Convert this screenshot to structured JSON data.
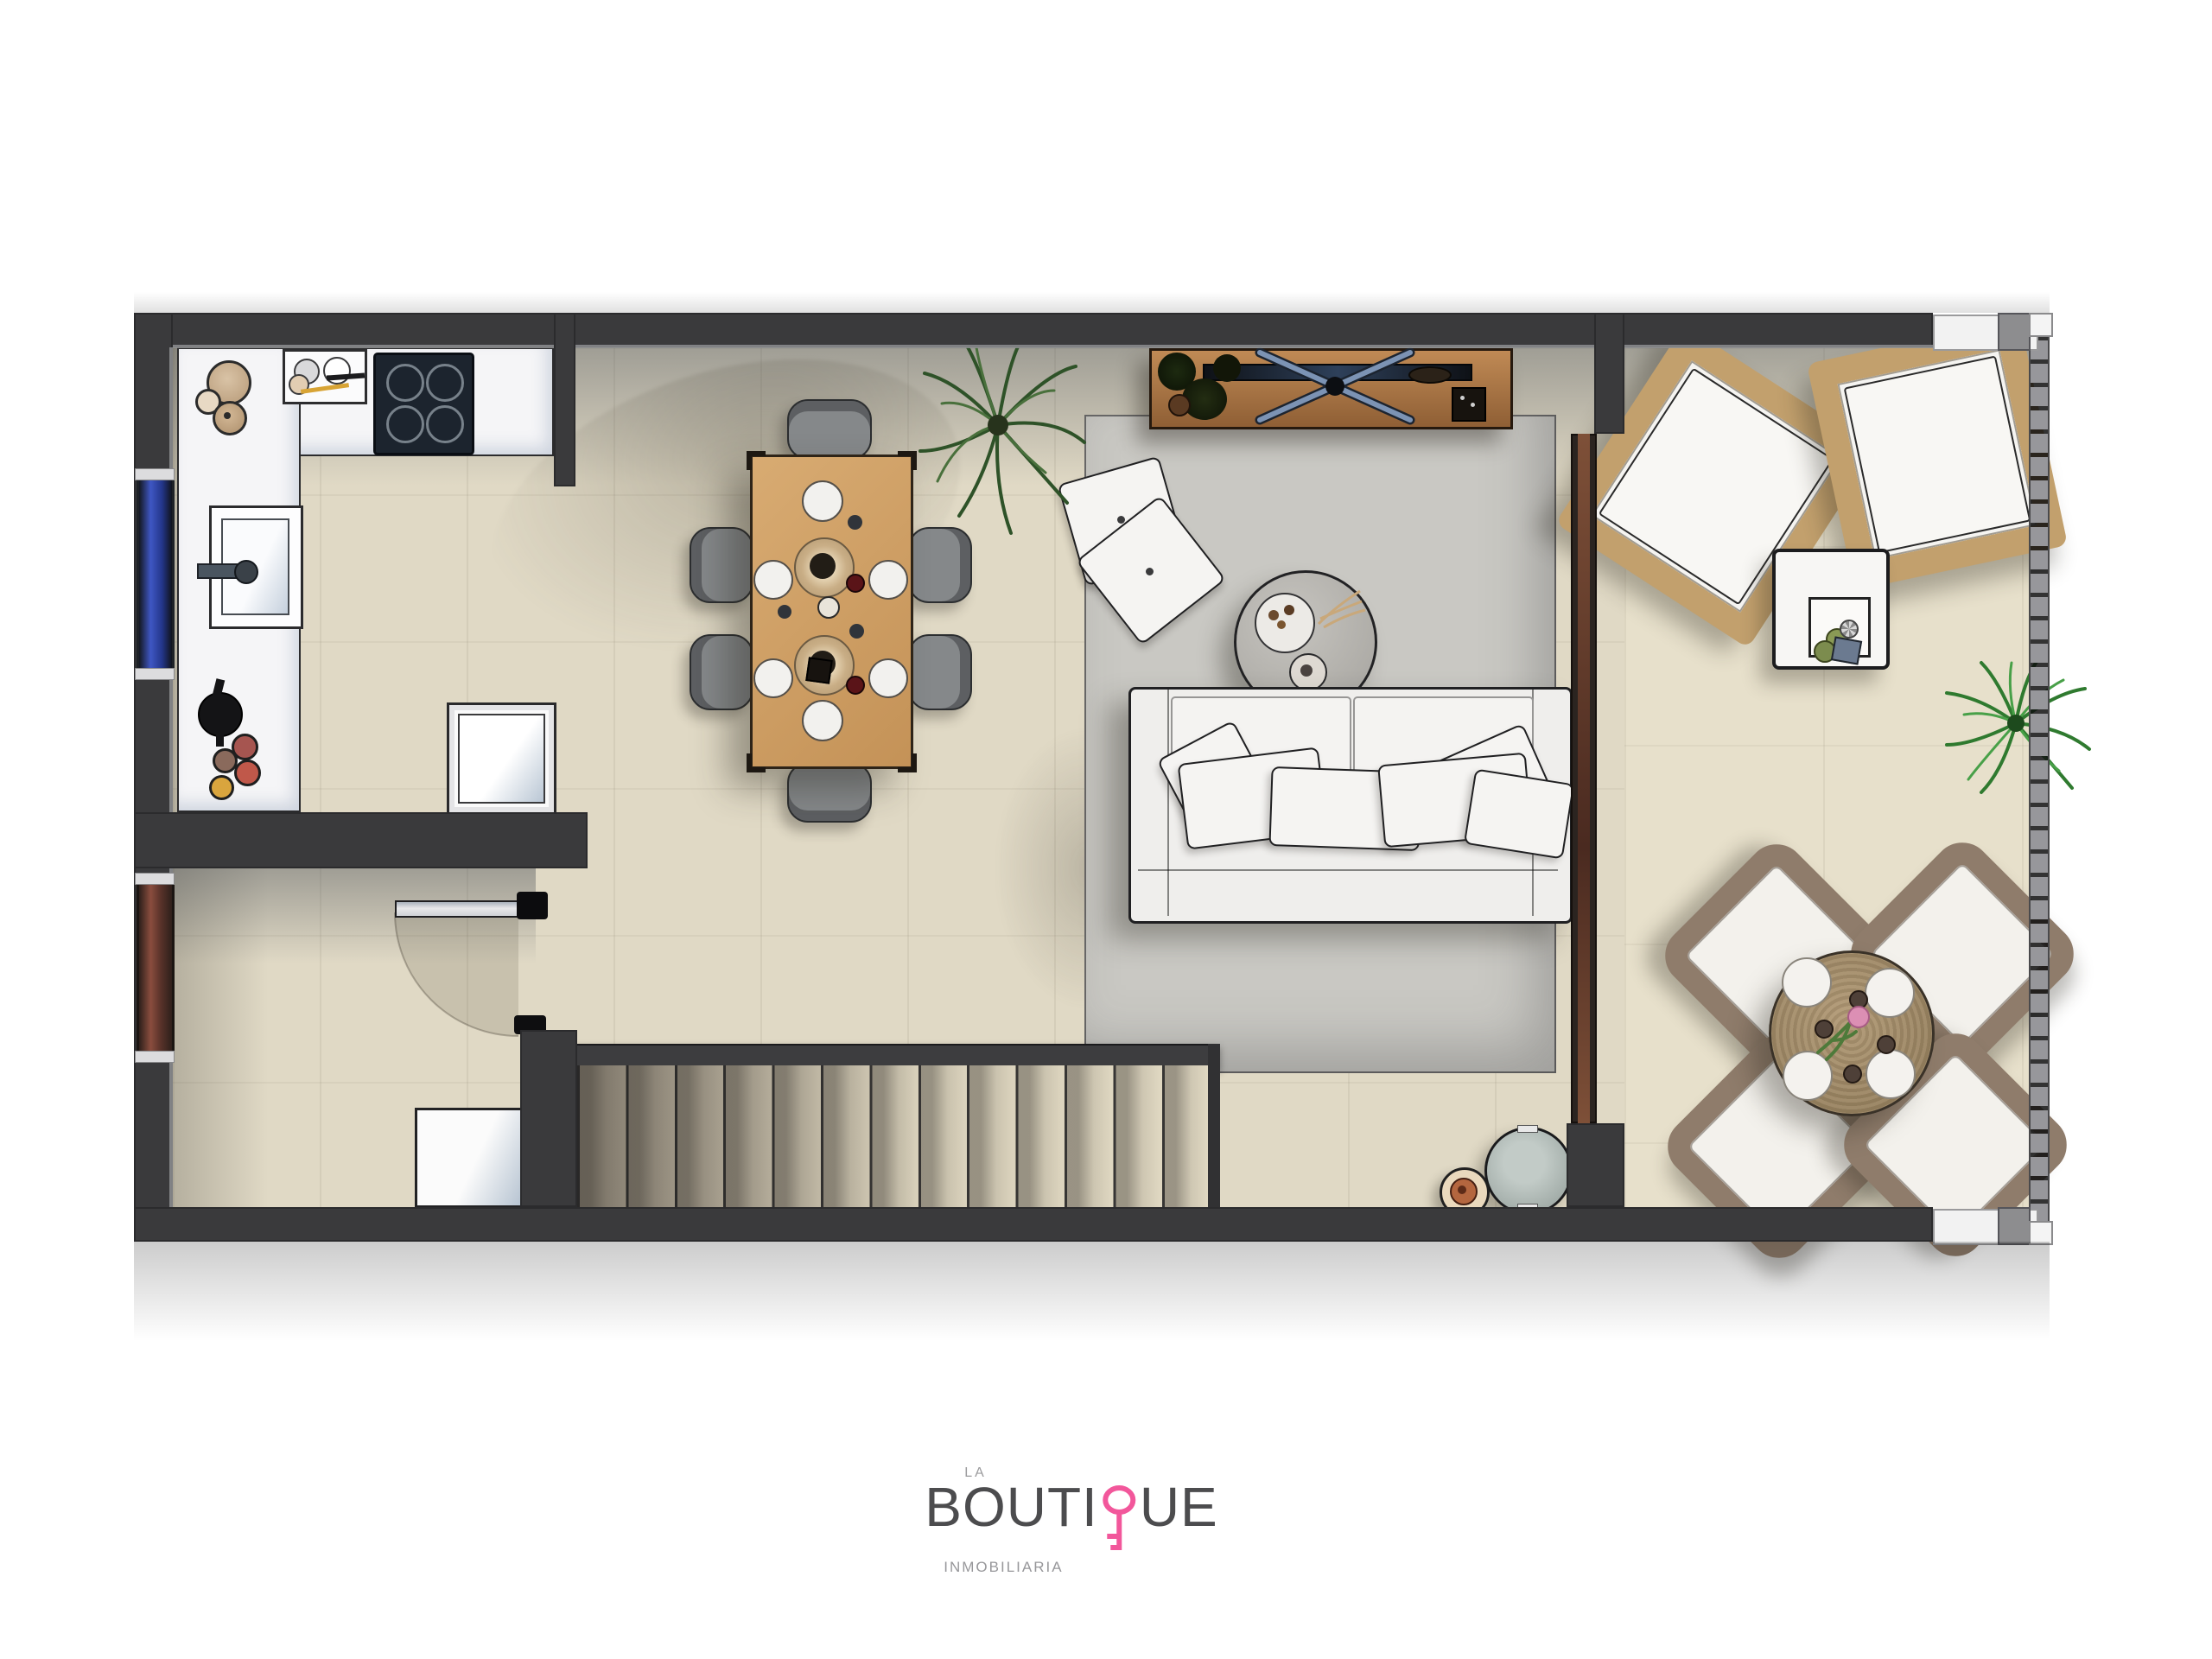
{
  "brand": {
    "line1": "LA",
    "wordmark_left": "BOUTI",
    "wordmark_right": "UE",
    "wordmark_full": "BOUTIQUE",
    "subtitle": "INMOBILIARIA",
    "icon": "key-icon",
    "key_color": "#f2579b",
    "text_color": "#4c4c4e",
    "subtitle_color": "#97979a"
  },
  "palette": {
    "wall": "#3a3a3c",
    "floor_tile": "#e0d9c5",
    "terrace_tile": "#e7e0cb",
    "kitchen_counter": "#f5f5f7",
    "stove_glass": "#1c242e",
    "rug": "#c9c8c3",
    "dining_wood": "#cfa268",
    "sofa_fabric": "#efeeec",
    "rattan": "#c2a06d",
    "outdoor_wicker": "#8f7c6b",
    "window_glass_blue": "#3f57c4",
    "door_wood_brown": "#7a4535",
    "plant_green": "#3f8f3f"
  }
}
